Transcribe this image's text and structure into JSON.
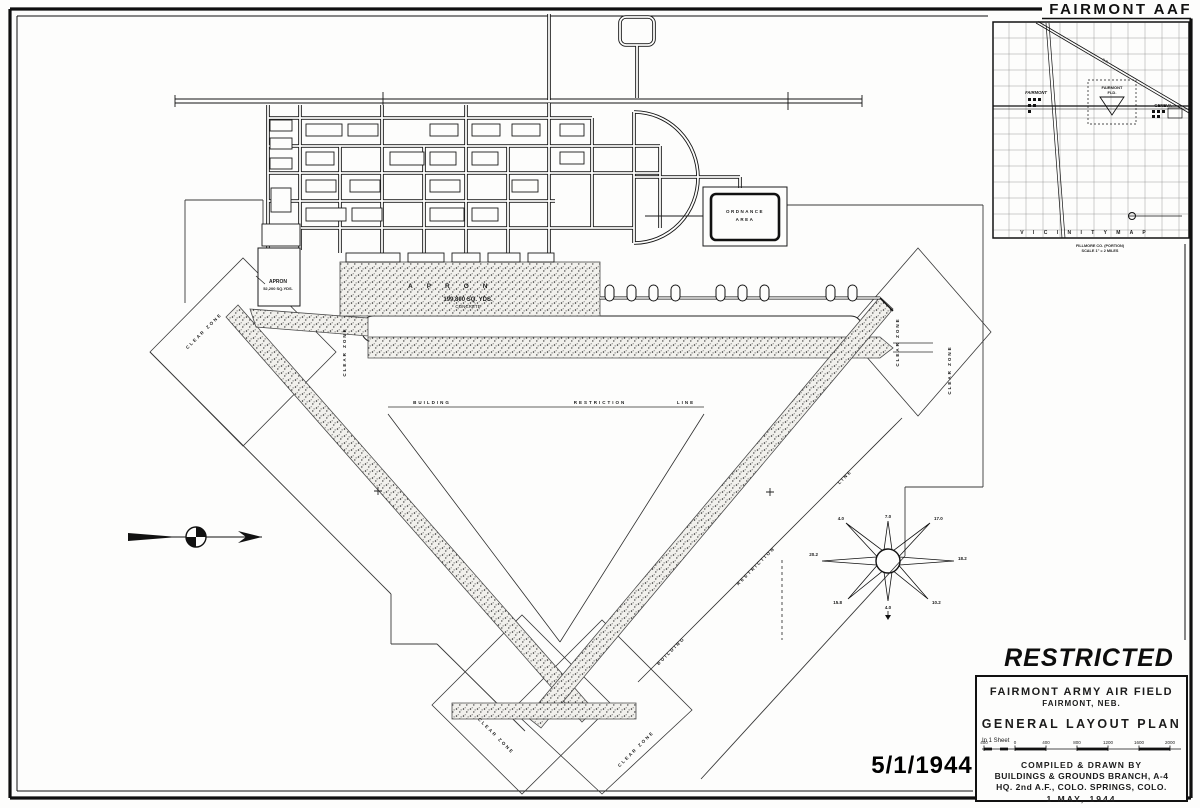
{
  "sheet": {
    "restricted": "RESTRICTED",
    "date_stamp": "5/1/1944"
  },
  "title_block": {
    "line1": "FAIRMONT ARMY AIR FIELD",
    "line2": "FAIRMONT,  NEB.",
    "line3": "GENERAL  LAYOUT  PLAN",
    "sheet_note": "In 1 Sheet",
    "scale_ticks": [
      "400",
      "0",
      "400",
      "800",
      "1200",
      "1600",
      "2000"
    ],
    "credit1": "COMPILED & DRAWN BY",
    "credit2": "BUILDINGS & GROUNDS BRANCH, A-4",
    "credit3": "HQ. 2nd A.F., COLO. SPRINGS, COLO.",
    "credit4": "1  MAY,  1944"
  },
  "vicinity_map": {
    "title": "FAIRMONT  AAF",
    "town": "FAIRMONT",
    "field_line1": "FAIRMONT",
    "field_line2": "FLD.",
    "geneva": "GENEVA",
    "railroad": "R.R.",
    "caption": "V I C I N I T Y      M A P",
    "sub1": "FILLMORE  CO. (PORTION)",
    "sub2": "SCALE  1\" = 2  MILES"
  },
  "map": {
    "ordnance_line1": "ORDNANCE",
    "ordnance_line2": "AREA",
    "apron_label": "APRON",
    "apron_area": "199,800  SQ. YDS.",
    "apron_surface": "CONCRETE",
    "apron_small_label": "APRON",
    "apron_small_area": "52,200 SQ.YDS.",
    "clear_zone": "CLEAR  ZONE",
    "brl_word1": "BUILDING",
    "brl_word2": "RESTRICTION",
    "brl_word3": "LINE",
    "wind_rose": {
      "n": "7.0",
      "ne": "17.0",
      "e": "18.2",
      "se": "10.2",
      "s": "4.0",
      "sw": "15.8",
      "w": "20.2",
      "nw": "4.0"
    }
  }
}
